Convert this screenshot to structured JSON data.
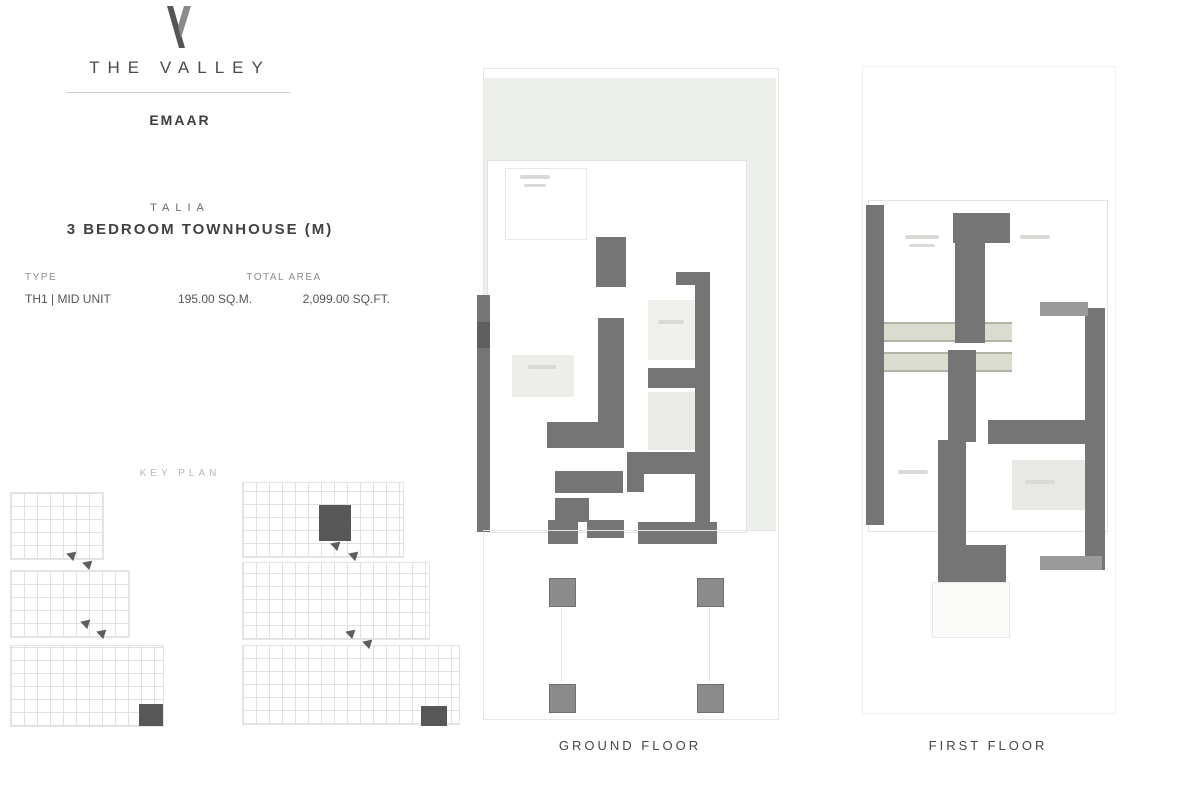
{
  "brand": {
    "logo_glyph": "V",
    "name": "THE VALLEY",
    "developer": "EMAAR"
  },
  "unit": {
    "collection": "TALIA",
    "title": "3 BEDROOM TOWNHOUSE (M)"
  },
  "specs": {
    "type_label": "TYPE",
    "type_value": "TH1 | MID UNIT",
    "area_label": "TOTAL AREA",
    "area_sqm": "195.00 SQ.M.",
    "area_sqft": "2,099.00 SQ.FT."
  },
  "key_plan": {
    "label": "KEY PLAN"
  },
  "plans": {
    "ground": {
      "label": "GROUND FLOOR"
    },
    "first": {
      "label": "FIRST FLOOR"
    }
  },
  "colors": {
    "garden_green": "#edf0ea",
    "wall_gray": "#757575",
    "highlight_dark": "#3f3f3f"
  }
}
